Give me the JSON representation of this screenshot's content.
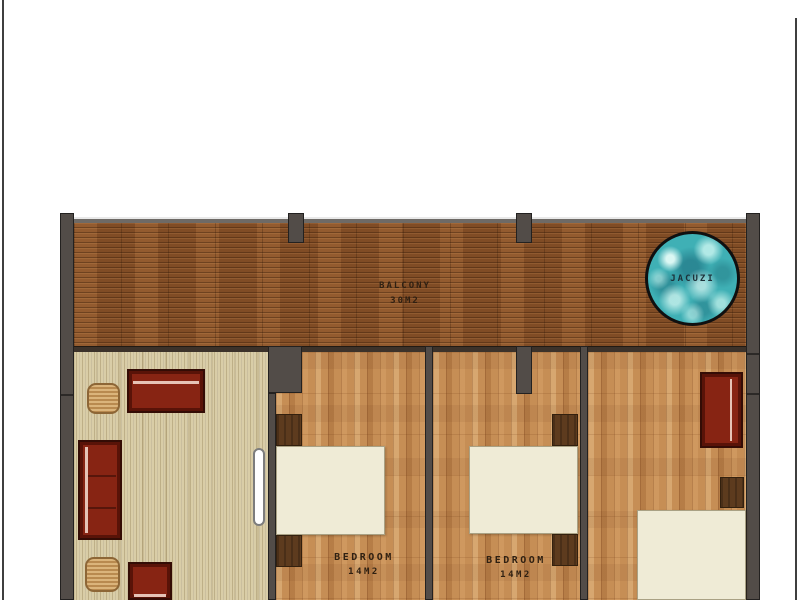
{
  "rooms": {
    "balcony": {
      "name": "BALCONY",
      "area": "30M2"
    },
    "jacuzzi": {
      "name": "JACUZI"
    },
    "bedroom_1": {
      "name": "BEDROOM",
      "area": "14M2"
    },
    "bedroom_2": {
      "name": "BEDROOM",
      "area": "14M2"
    }
  },
  "colors": {
    "deck_wood": "#8a5229",
    "bedroom_wood": "#c68e55",
    "living_floor": "#d9cda7",
    "wall": "#524c48",
    "sofa": "#872413",
    "sofa_trim": "#340c05",
    "table_wood": "#c89a5c",
    "bed": "#efebd6",
    "nightstand": "#5d3b1e",
    "water": "#3fb0b5",
    "label_text": "#2f2012"
  }
}
